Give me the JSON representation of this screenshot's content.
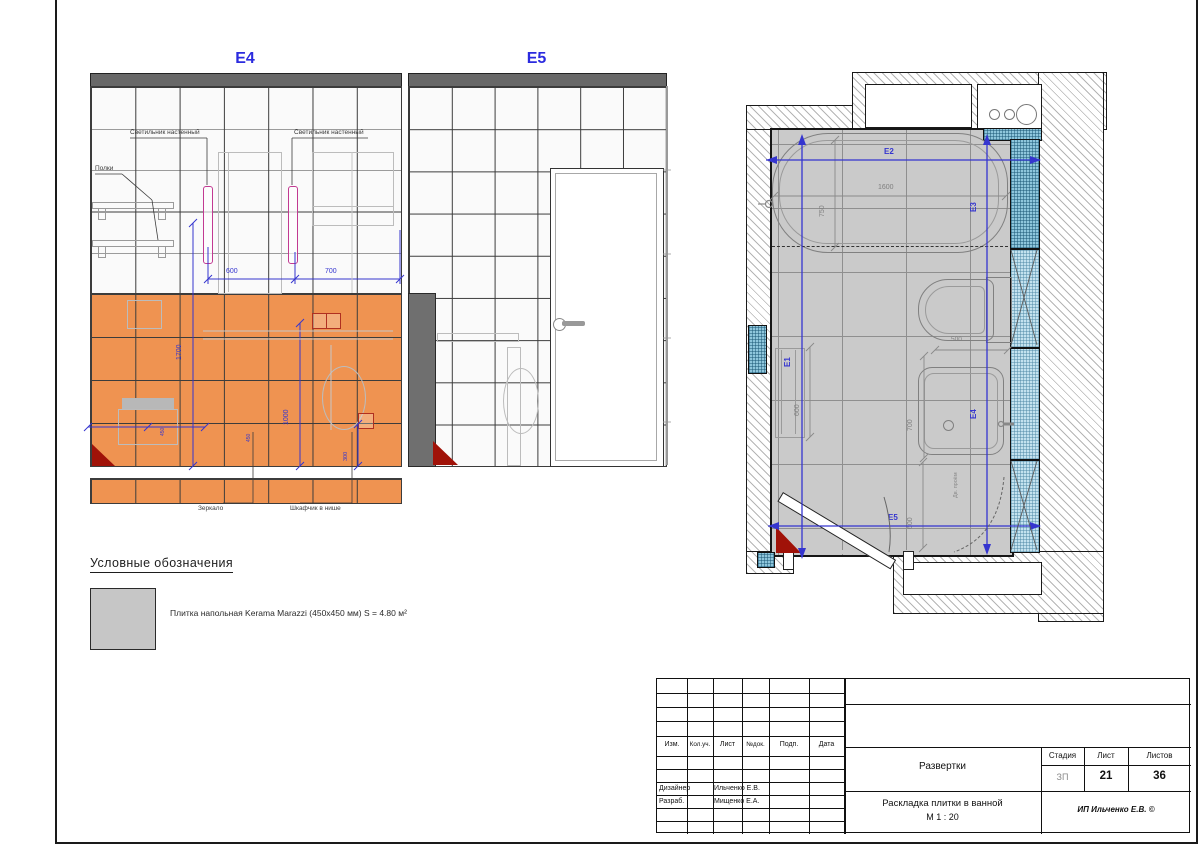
{
  "e4": {
    "title": "E4",
    "labels": {
      "light1": "Светильник настенный",
      "light2": "Светильник настенный",
      "shelves": "Полки",
      "mirror": "Зеркало",
      "cabinet": "Шкафчик в нише"
    },
    "dims": {
      "d600": "600",
      "d700": "700",
      "d1700": "1700",
      "d1000": "1000",
      "d300": "300",
      "d450a": "450",
      "d450b": "450"
    }
  },
  "e5": {
    "title": "E5"
  },
  "plan": {
    "markers": {
      "e1": "E1",
      "e2": "E2",
      "e3": "E3",
      "e4": "E4",
      "e5": "E5"
    },
    "dims": {
      "tub_len": "1600",
      "tub_wid": "750",
      "toilet": "500",
      "sink": "700",
      "rail": "600",
      "door": "600"
    },
    "note": "Дв. проём"
  },
  "legend": {
    "title": "Условные обозначения",
    "items": [
      {
        "label": "Плитка напольная Kerama Marazzi (450x450 мм) S = 4.80 м²",
        "swatch": "#c6c6c6"
      }
    ]
  },
  "titleblock": {
    "cols": [
      "Изм.",
      "Кол.уч.",
      "Лист",
      "№док.",
      "Подп.",
      "Дата"
    ],
    "rows": [
      {
        "role": "Дизайнер",
        "name": "Ильченко Е.В."
      },
      {
        "role": "Разраб.",
        "name": "Мищенко Е.А."
      }
    ],
    "doc": "Развертки",
    "stage_h": "Стадия",
    "sheet_h": "Лист",
    "sheets_h": "Листов",
    "stage": "ЗП",
    "sheet": "21",
    "sheets": "36",
    "title": "Раскладка плитки в ванной",
    "scale": "М 1 : 20",
    "company": "ИП Ильченко Е.В. ©"
  },
  "colors": {
    "accent_blue": "#3535cf",
    "tile_orange": "#ef9351",
    "lamp_pink": "#c23a92",
    "outlet_red": "#b03020",
    "niche_blue": "#8ec6dc",
    "floor_gray": "#cacaca"
  }
}
